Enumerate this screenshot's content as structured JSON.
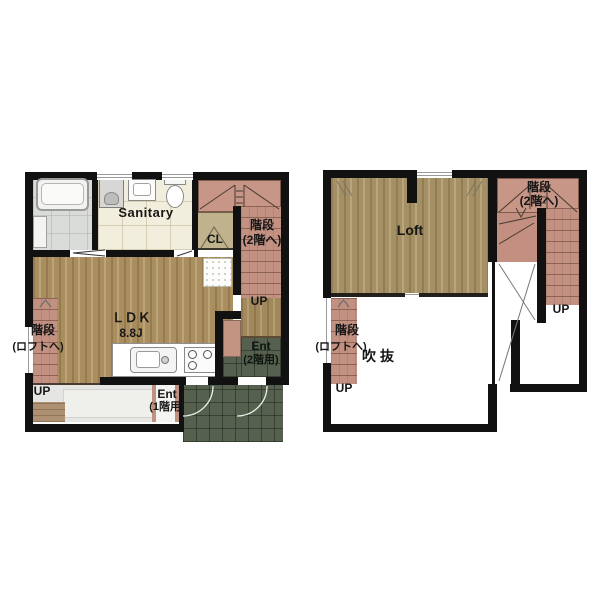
{
  "document": {
    "kind": "floor-plan",
    "background": "#ffffff"
  },
  "colors": {
    "wall": "#111111",
    "wood_floor": "#a98e60",
    "stair": "#c29182",
    "entrance_tile": "#55604e",
    "sanitary_floor": "#f2eedd",
    "bath_floor": "#d9dcd9",
    "closet": "#bfb28c",
    "deck": "#ae9172",
    "porch": "#e5e5e3"
  },
  "floor1": {
    "labels": {
      "sanitary": "Sanitary",
      "cl": "CL",
      "stairs_upper_line1": "階段",
      "stairs_upper_line2": "(2階へ)",
      "stairs_upper_up": "UP",
      "ldk_line1": "ＬＤＫ",
      "ldk_line2": "8.8J",
      "stairs_loft_line1": "階段",
      "stairs_loft_line2": "(ロフトへ)",
      "stairs_loft_up": "UP",
      "ent2_line1": "Ent",
      "ent2_line2": "(2階用)",
      "ent1_line1": "Ent",
      "ent1_line2": "(1階用)"
    }
  },
  "floor2": {
    "labels": {
      "loft": "Loft",
      "stairs_upper_line1": "階段",
      "stairs_upper_line2": "(2階へ)",
      "stairs_upper_up": "UP",
      "stairs_loft_line1": "階段",
      "stairs_loft_line2": "(ロフトへ)",
      "stairs_loft_up": "UP",
      "void": "吹抜"
    }
  }
}
